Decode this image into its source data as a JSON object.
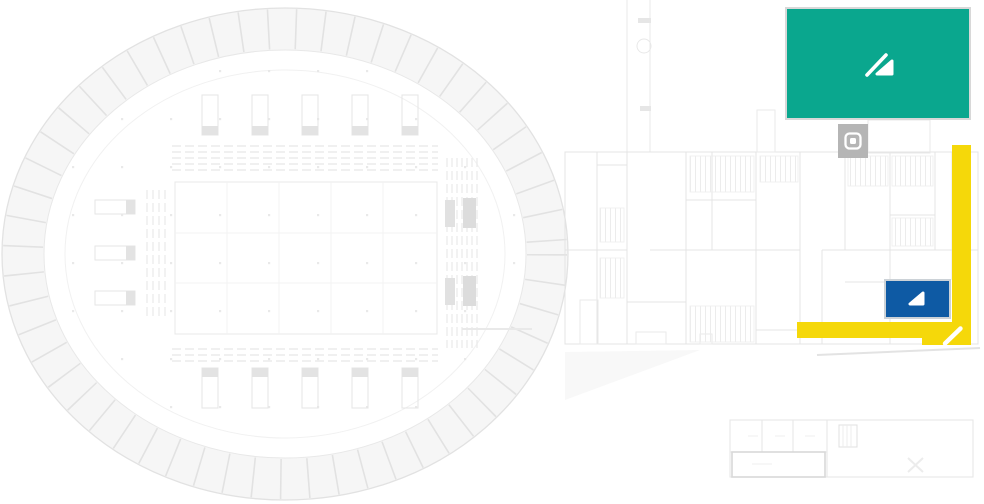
{
  "app": {
    "view": "facility-floorplan-map",
    "description_visible_text": ""
  },
  "plan": {
    "background": "#FFFFFF",
    "wall_color": "#E4E4E4",
    "detail_color": "#EDEDED",
    "band_color": "#F7F7F7",
    "accent_color": "#E0E0E0",
    "dark_bar_color": "#DCDCDC"
  },
  "zones": [
    {
      "id": "teal",
      "label": "teal-highlight-zone",
      "color": "#0AA78E",
      "icon": "pen-slope-icon",
      "icon_color": "#FFFFFF"
    },
    {
      "id": "yellow",
      "label": "yellow-route-highlight",
      "color": "#F5D80A",
      "icon": "pen-stroke-icon",
      "icon_color": "#FFFFFF"
    },
    {
      "id": "blue",
      "label": "blue-room-highlight",
      "color": "#0E5AA4",
      "icon": "corner-triangle-icon",
      "icon_color": "#FFFFFF"
    },
    {
      "id": "gray",
      "label": "elevator-marker",
      "color": "#B5B5B5",
      "icon": "elevator-frame-icon",
      "icon_color": "#FFFFFF"
    }
  ]
}
